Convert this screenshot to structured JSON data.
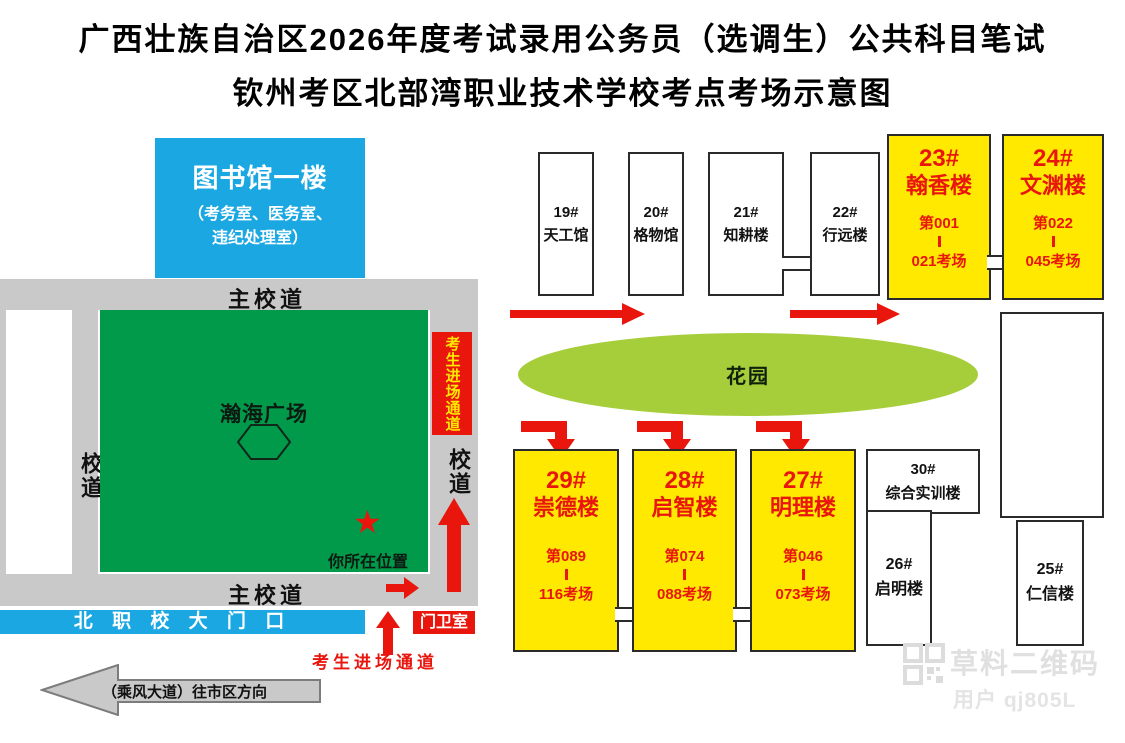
{
  "title": {
    "line1": "广西壮族自治区2026年度考试录用公务员（选调生）公共科目笔试",
    "line2": "钦州考区北部湾职业技术学校考点考场示意图"
  },
  "left_map": {
    "library": {
      "title": "图书馆一楼",
      "note_line1": "（考务室、医务室、",
      "note_line2": "违纪处理室）"
    },
    "roads": {
      "top": "主校道",
      "bottom": "主校道",
      "left": "校道",
      "right": "校道"
    },
    "plaza": {
      "name": "瀚海广场",
      "you_are_here": "你所在位置"
    },
    "entry_channel_side": "考生进场通道",
    "entry_channel_gate": "考生进场通道",
    "gate_label": "北 职 校 大 门 口",
    "guard_room": "门卫室",
    "avenue": "（乘风大道）往市区方向"
  },
  "campus": {
    "garden": "花园",
    "buildings": {
      "b19": {
        "id": "19#",
        "name": "天工馆"
      },
      "b20": {
        "id": "20#",
        "name": "格物馆"
      },
      "b21": {
        "id": "21#",
        "name": "知耕楼"
      },
      "b22": {
        "id": "22#",
        "name": "行远楼"
      },
      "b23": {
        "id": "23#",
        "name": "翰香楼",
        "room_from": "第001",
        "room_to": "021考场"
      },
      "b24": {
        "id": "24#",
        "name": "文渊楼",
        "room_from": "第022",
        "room_to": "045考场"
      },
      "b25": {
        "id": "25#",
        "name": "仁信楼"
      },
      "b26": {
        "id": "26#",
        "name": "启明楼"
      },
      "b27": {
        "id": "27#",
        "name": "明理楼",
        "room_from": "第046",
        "room_to": "073考场"
      },
      "b28": {
        "id": "28#",
        "name": "启智楼",
        "room_from": "第074",
        "room_to": "088考场"
      },
      "b29": {
        "id": "29#",
        "name": "崇德楼",
        "room_from": "第089",
        "room_to": "116考场"
      },
      "b30": {
        "id": "30#",
        "name": "综合实训楼"
      }
    }
  },
  "watermark": {
    "brand": "草料二维码",
    "user": "用户 qj805L"
  },
  "colors": {
    "blue": "#1aa7e2",
    "green": "#009a4a",
    "garden_green": "#a6ce3b",
    "yellow": "#ffe900",
    "red": "#e8160c",
    "road_gray": "#c9c9c9"
  }
}
